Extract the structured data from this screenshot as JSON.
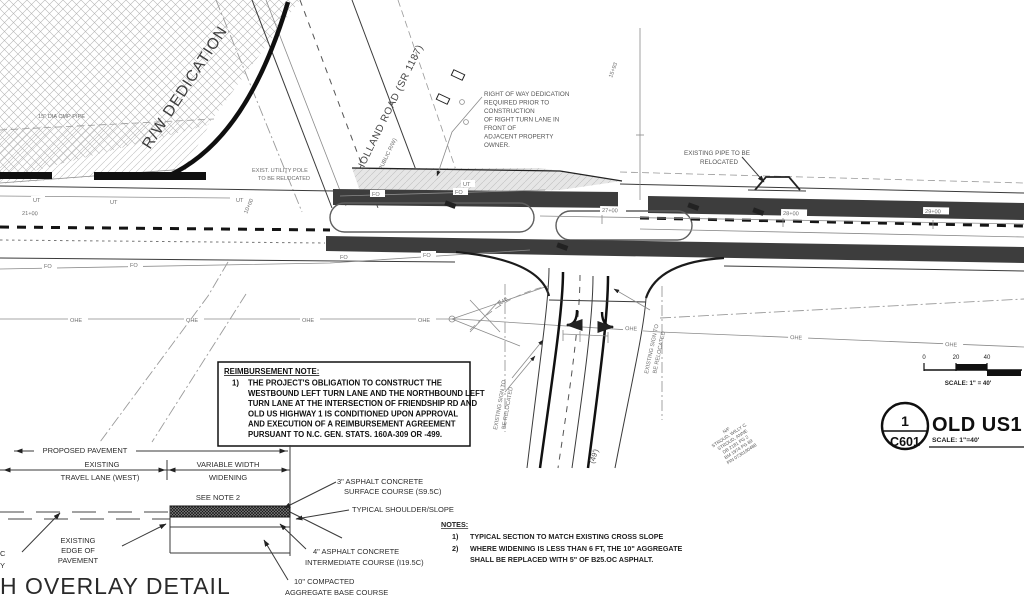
{
  "plan": {
    "rw_dedication": "R/W DEDICATION",
    "holland_name": "HOLLAND ROAD (SR 1187)",
    "holland_rw": "(60' PUBLIC R/W)",
    "pipe_dia": "15\" DIA CMP PIPE",
    "row_note": [
      "RIGHT OF WAY DEDICATION",
      "REQUIRED PRIOR TO",
      "CONSTRUCTION",
      "OF RIGHT TURN LANE IN",
      "FRONT OF",
      "ADJACENT PROPERTY",
      "OWNER."
    ],
    "pipe_note": [
      "EXISTING PIPE TO BE",
      "RELOCATED"
    ],
    "pole_note": [
      "EXIST. UTILITY POLE",
      "TO BE RELOCATED"
    ],
    "sign_note": [
      "EXISTING SIGN TO",
      "BE RELOCATED"
    ],
    "owner_note": [
      "N/F",
      "STROUD, WILLY C.",
      "STROUD, ANNE",
      "DB 2181 PG 2",
      "BM 1974 PG 89",
      "PIN 0730190488"
    ],
    "radius_label": "R48",
    "length_label": "(49')",
    "stations": {
      "s10": "10+00",
      "s1593": "15+93",
      "s21": "21+00",
      "s27": "27+00",
      "s28": "28+00",
      "s29": "29+00"
    },
    "line_labels": {
      "fo": "FO",
      "ohe": "OHE",
      "ut": "UT"
    }
  },
  "reimbursement_note": {
    "heading": "REIMBURSEMENT NOTE:",
    "item_no": "1)",
    "lines": [
      "THE PROJECT'S OBLIGATION TO CONSTRUCT THE",
      "WESTBOUND LEFT TURN LANE AND THE NORTHBOUND LEFT",
      "TURN LANE AT THE INTERSECTION OF FRIENDSHIP RD AND",
      "OLD US HIGHWAY 1 IS CONDITIONED UPON APPROVAL",
      "AND EXECUTION OF A REIMBURSEMENT AGREEMENT",
      "PURSUANT TO N.C. GEN. STATS. 160A-309 OR -499."
    ]
  },
  "detail": {
    "title": "H OVERLAY DETAIL",
    "dim_proposed": "PROPOSED PAVEMENT",
    "dim_existing_1": "EXISTING",
    "dim_existing_2": "TRAVEL LANE (WEST)",
    "dim_widening_1": "VARIABLE WIDTH",
    "dim_widening_2": "WIDENING",
    "see_note": "SEE NOTE 2",
    "edge_label_1": "EXISTING",
    "edge_label_2": "EDGE OF",
    "edge_label_3": "PAVEMENT",
    "surface_label_1": "3\" ASPHALT CONCRETE",
    "surface_label_2": "SURFACE COURSE (S9.5C)",
    "shoulder_label": "TYPICAL SHOULDER/SLOPE",
    "intermediate_label_1": "4\" ASPHALT CONCRETE",
    "intermediate_label_2": "INTERMEDIATE COURSE (I19.5C)",
    "base_label_1": "10\" COMPACTED",
    "base_label_2": "AGGREGATE BASE COURSE",
    "fragment_c": "C",
    "fragment_y": "Y"
  },
  "section_notes": {
    "heading": "NOTES:",
    "items": [
      {
        "no": "1)",
        "lines": [
          "TYPICAL SECTION TO MATCH EXISTING CROSS SLOPE"
        ]
      },
      {
        "no": "2)",
        "lines": [
          "WHERE WIDENING IS LESS THAN 6 FT, THE 10\" AGGREGATE",
          "SHALL BE REPLACED WITH 5\" OF B25.OC ASPHALT."
        ]
      }
    ]
  },
  "title_block": {
    "detail_number": "1",
    "sheet_number": "C601",
    "title": "OLD US1 H",
    "scale_text": "SCALE: 1\"=40'"
  },
  "scale_bar": {
    "t0": "0",
    "t20": "20",
    "t40": "40",
    "label": "SCALE: 1\" = 40'"
  },
  "colors": {
    "paving_dark": "#3d3d3d",
    "hatch_gray": "#b5b5b5",
    "line_dark": "#1a1a1a"
  }
}
